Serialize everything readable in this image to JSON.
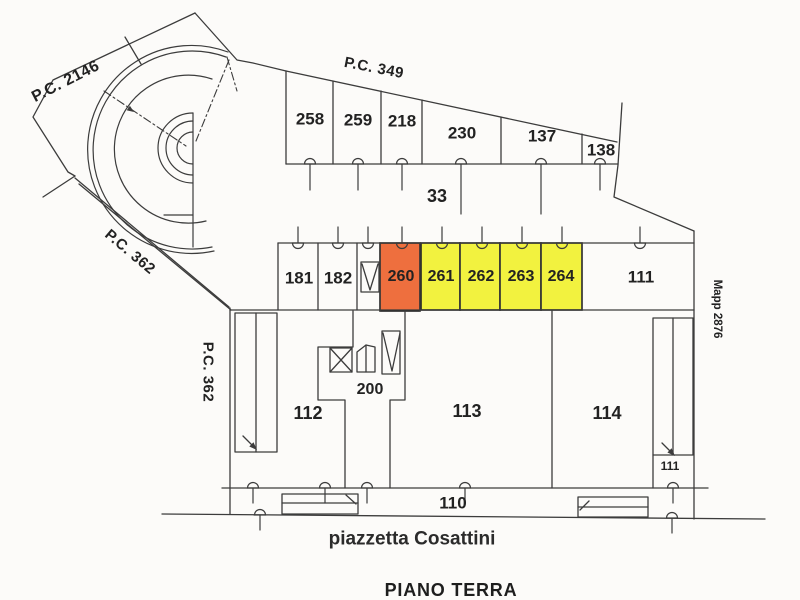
{
  "document": {
    "title": "PIANO TERRA",
    "street_label": "piazzetta Cosattini"
  },
  "boundary_labels": {
    "pc_2146": "P.C. 2146",
    "pc_349": "P.C. 349",
    "pc_362_upper": "P.C. 362",
    "pc_362_lower": "P.C. 362",
    "mapp_2876": "Mapp 2876"
  },
  "upper_strip_units": [
    "258",
    "259",
    "218",
    "230",
    "137",
    "138"
  ],
  "courtyard_label": "33",
  "main_row_units": [
    "181",
    "182",
    "260",
    "261",
    "262",
    "263",
    "264",
    "111"
  ],
  "ground_rooms": {
    "r200": "200",
    "r112": "112",
    "r113": "113",
    "r114": "114",
    "r110": "110",
    "r111_small": "111"
  },
  "highlighted": {
    "orange_unit": "260",
    "yellow_units": [
      "261",
      "262",
      "263",
      "264"
    ]
  },
  "colors": {
    "highlight_orange": "#ee6f3e",
    "highlight_yellow": "#f2f23f",
    "line": "#3c3c3c"
  }
}
